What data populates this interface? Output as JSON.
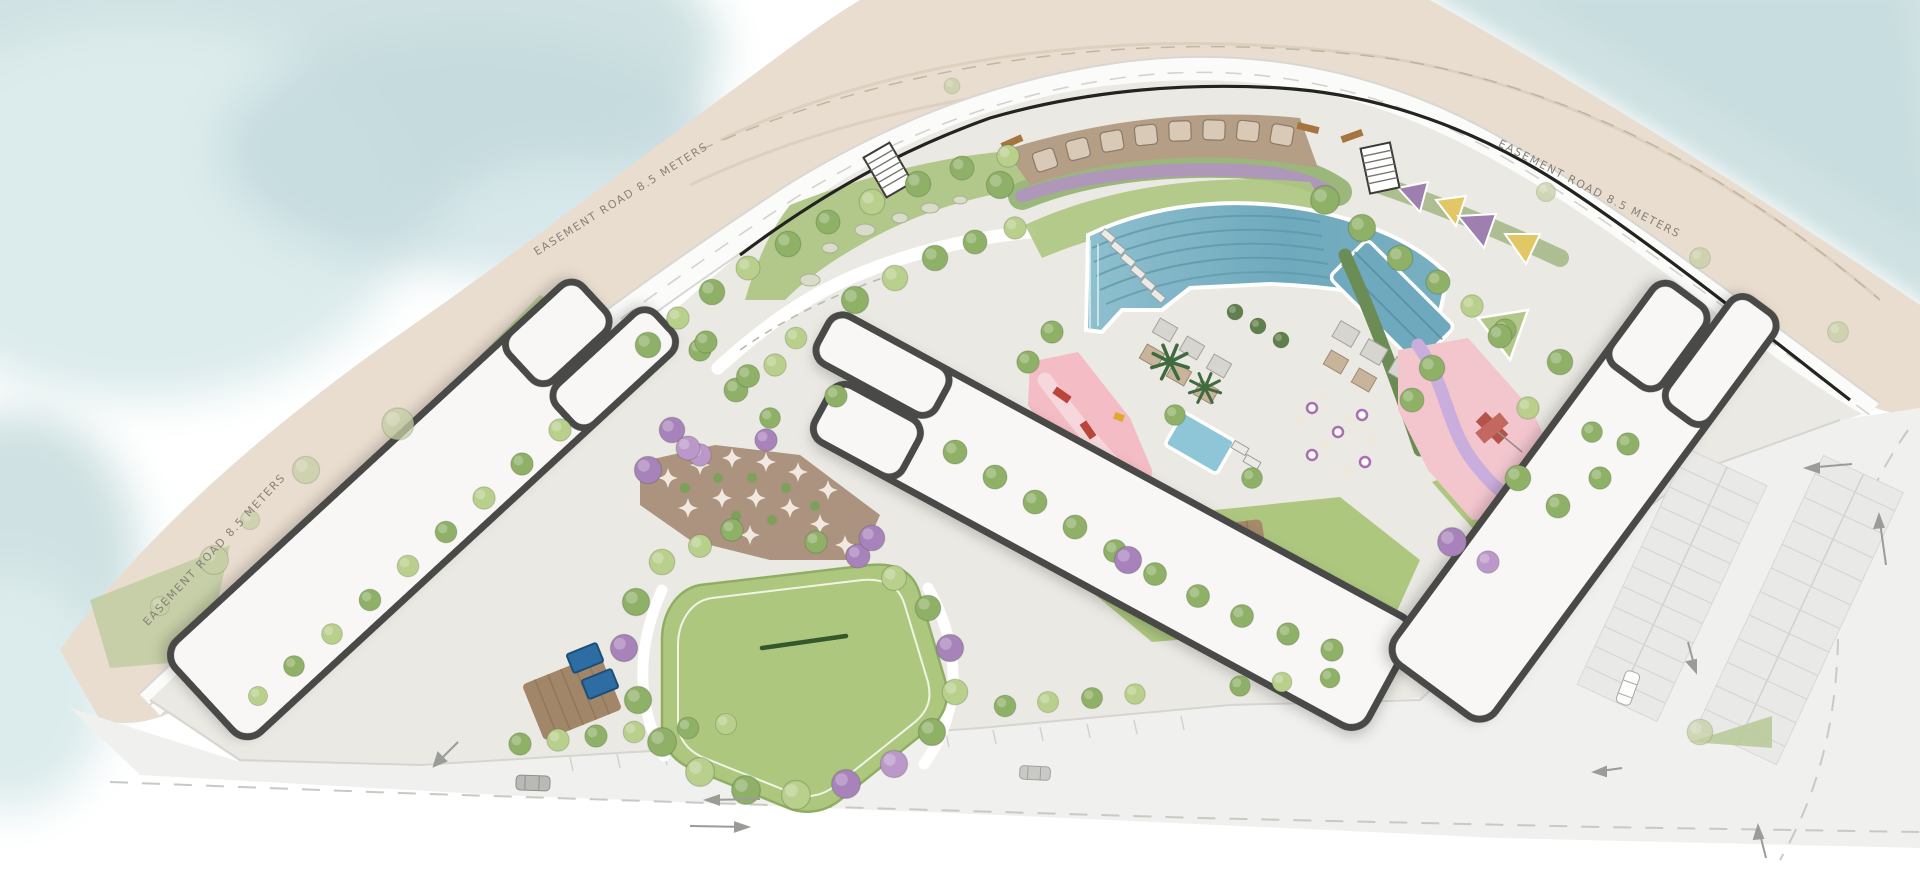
{
  "map": {
    "type": "landscape-masterplan-site-plan",
    "labels": {
      "easement_top_left": "EASEMENT ROAD 8.5 METERS",
      "easement_top_right": "EASEMENT ROAD 8.5 METERS",
      "easement_bottom_left": "EASEMENT ROAD 8.5 METERS"
    },
    "palette": {
      "water": "#cfe1e2",
      "sand": "#e9ddcf",
      "road": "#fbfbfa",
      "asphalt": "#f0f0ee",
      "paving": "#ebe9e3",
      "lawn": "#adc77f",
      "pool_water": "#74aabe",
      "pink_play": "#f3c6ce",
      "pink_gym": "#f4bcc4",
      "purple_planting": "#b292c4",
      "deck_brown": "#b59e86",
      "tree_green": "#8fb067",
      "tree_purple": "#a883bb",
      "building_fill": "#f8f7f5",
      "building_outline": "#4a4946",
      "label_color": "#8a8178"
    }
  }
}
